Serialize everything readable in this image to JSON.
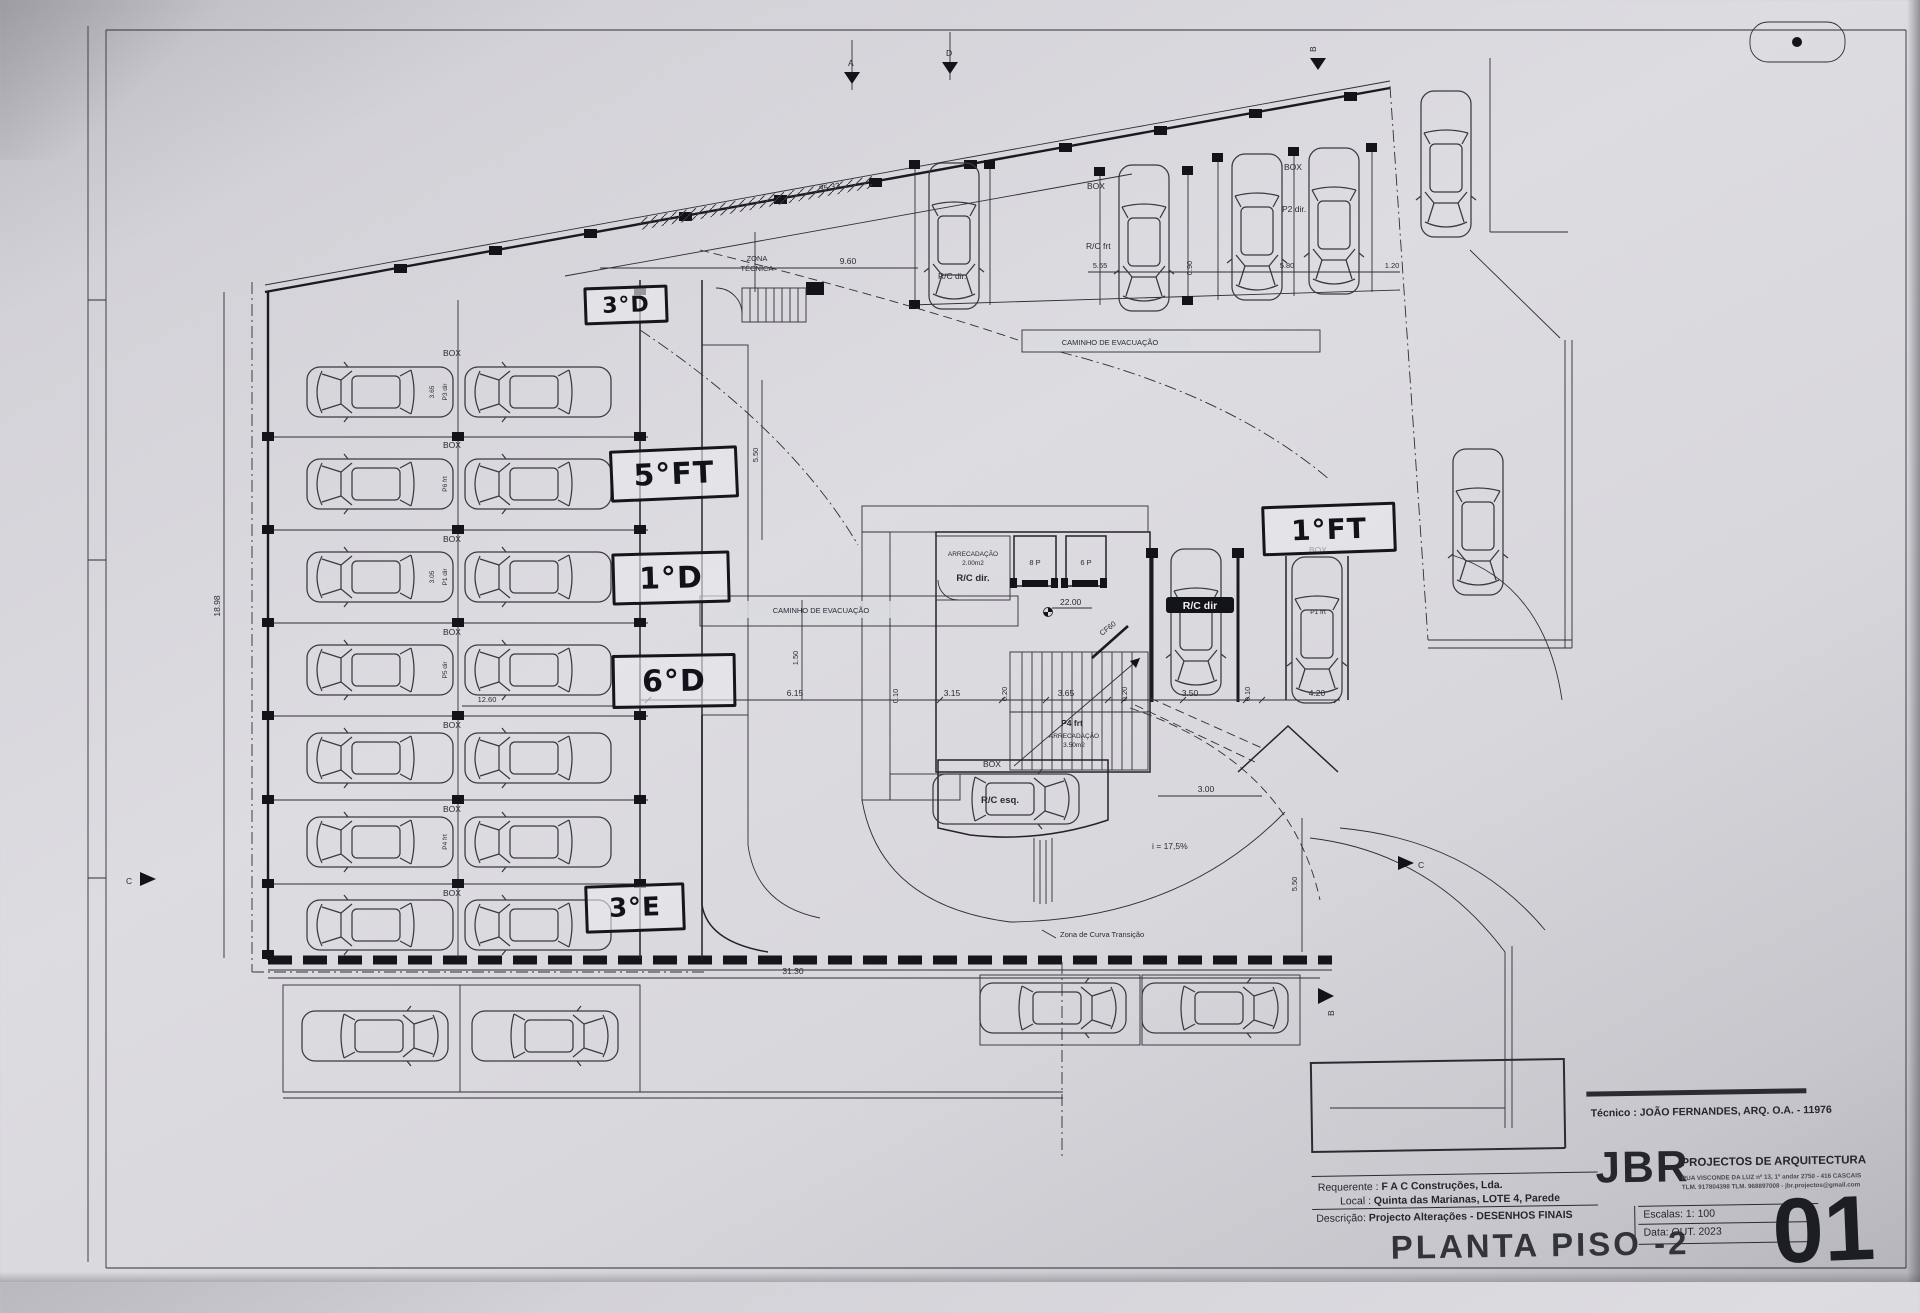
{
  "sheet": {
    "title": "PLANTA PISO -2",
    "number": "01",
    "tecnico": "Técnico : JOÃO FERNANDES, ARQ.   O.A. - 11976",
    "requerente_label": "Requerente :",
    "requerente_value": "F A C  Construções, Lda.",
    "local_label": "Local :",
    "local_value": "Quinta das Marianas, LOTE 4, Parede",
    "descricao_label": "Descrição:",
    "descricao_value": "Projecto Alterações - DESENHOS FINAIS",
    "escala_label": "Escalas:",
    "escala_value": "1: 100",
    "data_label": "Data:",
    "data_value": "OUT. 2023",
    "firm": {
      "name": "JBR",
      "tagline": "PROJECTOS DE ARQUITECTURA",
      "address": "RUA VISCONDE DA LUZ nº 13, 1º andar  2750 - 416  CASCAIS",
      "contacts": "TLM. 917804398  TLM. 968897008 - jbr.projectos@gmail.com"
    }
  },
  "handwritten": {
    "l3d": "3°D",
    "l5ft": "5°FT",
    "l1d": "1°D",
    "l6d": "6°D",
    "l3e": "3°E",
    "l1ft": "1°FT"
  },
  "labels": {
    "zona_tecnica_1": "ZONA",
    "zona_tecnica_2": "TÉCNICA",
    "caminho_evac": "CAMINHO DE EVACUAÇÃO",
    "box": "BOX",
    "rc_frt": "R/C frt",
    "rc_dir": "R/C dir.",
    "rc_dir_bar": "R/C dir",
    "rc_esq": "R/C esq.",
    "p2_dir": "P2 dir.",
    "p1_frt": "P1 frt",
    "p4_frt": "P4 frt",
    "arrecadacao": "ARRECADAÇÃO",
    "arrec_area_1": "2.00m2",
    "arrec_area_2": "3.50m2",
    "elev_8p": "8 P",
    "elev_6p": "6 P",
    "cf60": "CF60",
    "level": "22.00",
    "slope": "i = 17,5%",
    "curva": "Zona de Curva Transição",
    "sec_a": "A",
    "sec_b": "B",
    "sec_c": "C",
    "sec_d": "D"
  },
  "parking_left": [
    {
      "box": "BOX",
      "id": "P3 dir"
    },
    {
      "box": "BOX",
      "id": "P6 frt"
    },
    {
      "box": "BOX",
      "id": "P1 dir"
    },
    {
      "box": "BOX",
      "id": "P5 dir"
    },
    {
      "box": "BOX",
      "id": ""
    },
    {
      "box": "BOX",
      "id": "P4 frt"
    },
    {
      "box": "BOX",
      "id": ""
    }
  ],
  "dims": {
    "d3533": "35.33",
    "d960": "9.60",
    "d565": "5.65",
    "d090": "0.90",
    "d580": "5.80",
    "d120": "1.20",
    "d1898": "18.98",
    "d365": "3.65",
    "d305": "3.05",
    "d1260": "12.60",
    "d3130": "31.30",
    "d615": "6.15",
    "d010": "0.10",
    "d315": "3.15",
    "d020": "0.20",
    "d350": "3.50",
    "d420": "4.20",
    "d300": "3.00",
    "d550": "5.50",
    "d150": "1.50"
  }
}
